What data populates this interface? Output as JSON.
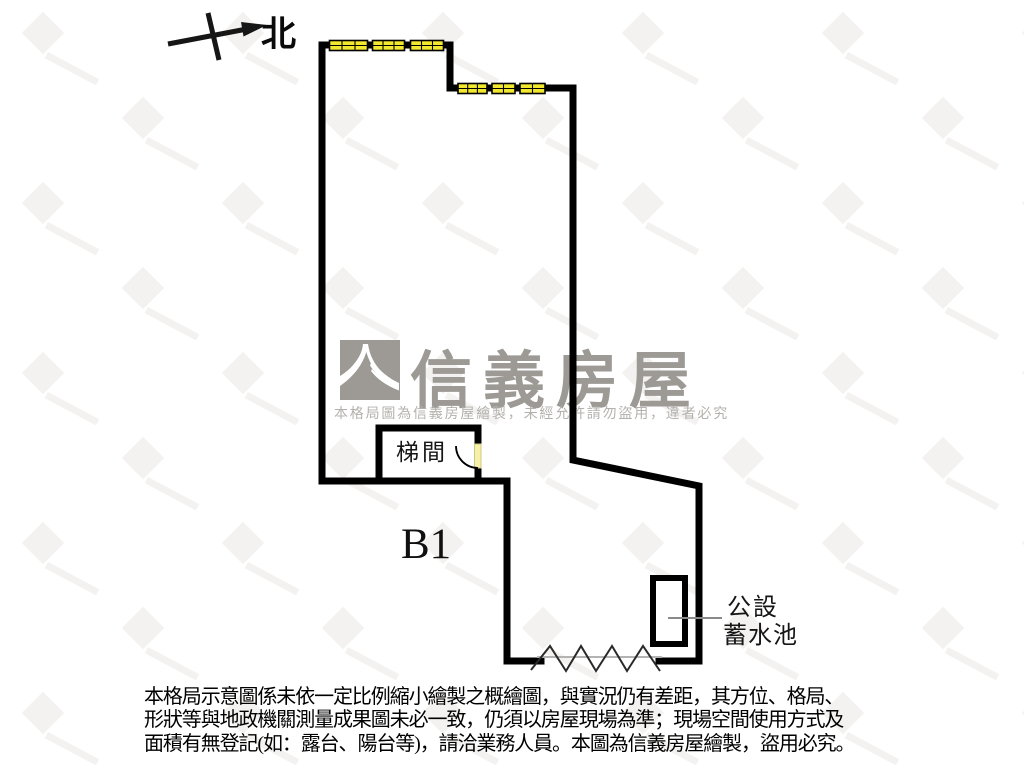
{
  "page": {
    "background": "#ffffff"
  },
  "compass": {
    "north_label": "北"
  },
  "logo": {
    "brand_name": "信義房屋",
    "notice": "本格局圖為信義房屋繪製，未經允許請勿盜用，違者必究",
    "brand_color": "#9d9a95"
  },
  "plan": {
    "floor_label": "B1",
    "stairwell_label": "梯間",
    "tank_label": {
      "line1": "公設",
      "line2": "蓄水池"
    },
    "colors": {
      "wall": "#000000",
      "window_glass": "#f2e82e",
      "door_leaf": "#f6f0a8",
      "leader_line": "#8a8a8a"
    }
  },
  "disclaimer": {
    "lines": [
      "本格局示意圖係未依一定比例縮小繪製之概繪圖，與實況仍有差距，其方位、格局、",
      "形狀等與地政機關測量成果圖未必一致，仍須以房屋現場為準；現場空間使用方式及",
      "面積有無登記(如：露台、陽台等)，請洽業務人員。本圖為信義房屋繪製，盜用必究。"
    ]
  }
}
